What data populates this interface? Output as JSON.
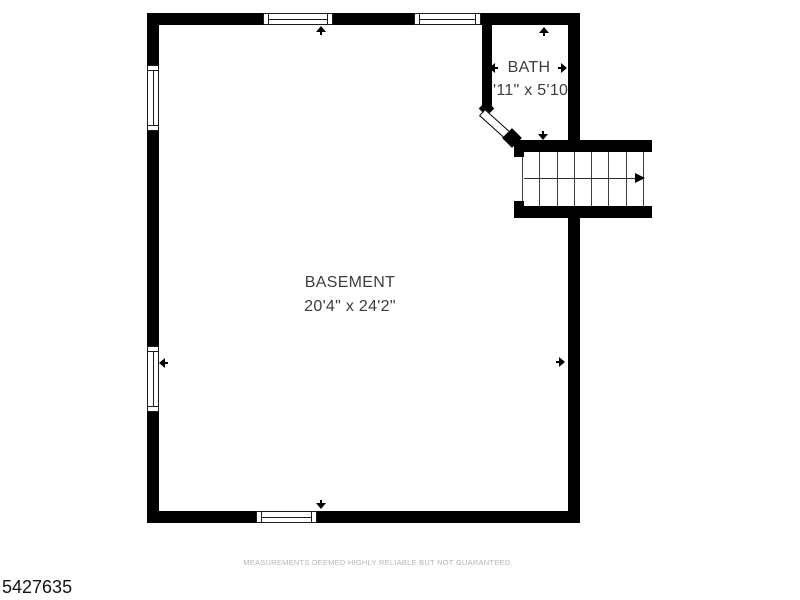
{
  "plan": {
    "type": "floor-plan",
    "floor": "basement-level",
    "rooms": {
      "basement": {
        "label": "BASEMENT",
        "dims": "20'4\" x 24'2\""
      },
      "bath": {
        "label": "BATH",
        "dims": "3'11\" x 5'10\""
      }
    },
    "stairs": {
      "tread_count": 7,
      "direction_arrow": "right"
    },
    "windows": [
      "top-wall-window-1",
      "top-wall-window-2",
      "left-wall-window-1",
      "left-wall-window-2",
      "bottom-wall-window"
    ],
    "doors": [
      "bath-door-diagonal"
    ],
    "dimension_markers": [
      "basement-up",
      "basement-down",
      "basement-left",
      "basement-right",
      "bath-up",
      "bath-down",
      "bath-left",
      "bath-right"
    ]
  },
  "footer": {
    "disclaimer": "MEASUREMENTS DEEMED HIGHLY RELIABLE BUT NOT GUARANTEED.",
    "listing_id": "5427635"
  },
  "colors": {
    "wall": "#000000",
    "background": "#ffffff",
    "label_text": "#3d3d3d",
    "disclaimer_text": "#b5b5b5",
    "listing_id_text": "#141414"
  }
}
